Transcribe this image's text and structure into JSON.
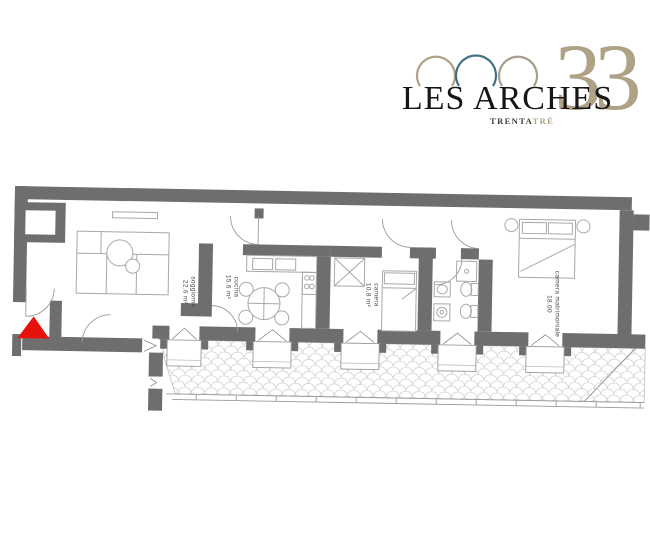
{
  "logo": {
    "title": "LES ARCHES",
    "number": "33",
    "subtitle_dark": "TRENTA",
    "subtitle_accent": "TRÉ",
    "colors": {
      "tan": "#b0a287",
      "teal": "#3e7183",
      "tan2": "#a79e8d",
      "text": "#161616"
    }
  },
  "floorplan": {
    "wall_color": "#6e6e6e",
    "entrance_color": "#e8120c",
    "furniture_line_color": "#a8a8a8",
    "rooms": [
      {
        "name": "soggiorno",
        "area": "22.6 m²"
      },
      {
        "name": "cucina",
        "area": "15.6 m²"
      },
      {
        "name": "camera",
        "area": "10.8 m²"
      },
      {
        "name": "camera matrimoniale",
        "area": "18.00"
      }
    ]
  }
}
